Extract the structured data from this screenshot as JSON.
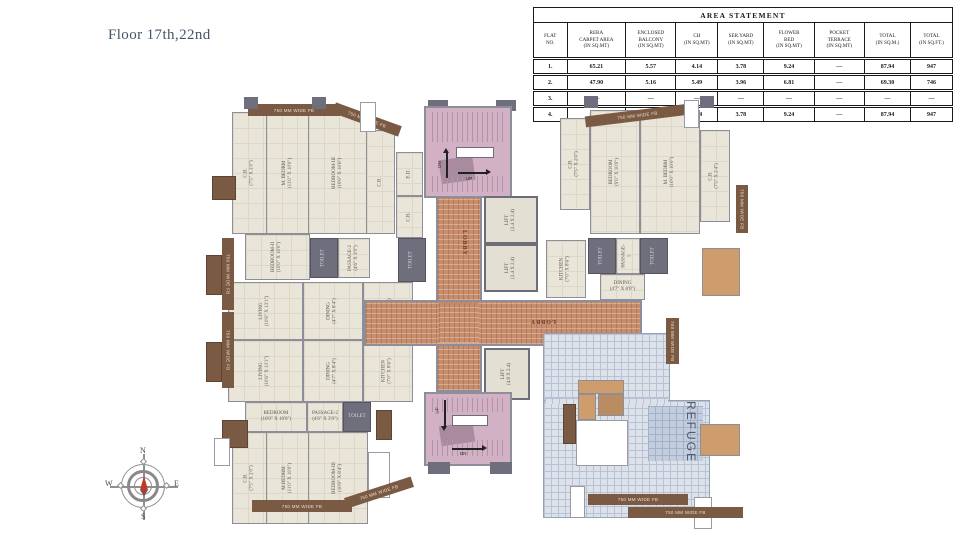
{
  "page": {
    "title": "Floor 17th,22nd"
  },
  "area_statement": {
    "title": "AREA STATEMENT",
    "columns": [
      "FLAT\nNO.",
      "RERA\nCARPET AREA\n(IN SQ.MT)",
      "ENCLOSED\nBALCONY\n(IN SQ.MT)",
      "CH\n(IN SQ.MT)",
      "SER.YARD\n(IN SQ.MT)",
      "FLOWER\nBED\n(IN SQ.MT)",
      "POCKET\nTERRACE\n(IN SQ.MT)",
      "TOTAL\n(IN SQ.M.)",
      "TOTAL\n(IN SQ.FT.)"
    ],
    "rows": [
      {
        "flat": "1.",
        "values": [
          "65.21",
          "5.57",
          "4.14",
          "3.78",
          "9.24",
          "—",
          "87.94",
          "947"
        ]
      },
      {
        "flat": "2.",
        "values": [
          "47.90",
          "5.16",
          "5.49",
          "3.96",
          "6.81",
          "—",
          "69.30",
          "746"
        ]
      },
      {
        "flat": "3.",
        "values": [
          "—",
          "—",
          "—",
          "—",
          "—",
          "—",
          "—",
          "—"
        ]
      },
      {
        "flat": "4.",
        "values": [
          "65.21",
          "5.57",
          "4.14",
          "3.78",
          "9.24",
          "—",
          "87.94",
          "947"
        ]
      }
    ]
  },
  "compass": {
    "n": "N",
    "e": "E",
    "s": "S",
    "w": "W"
  },
  "plan": {
    "lobby_label": "LOBBY",
    "refuge_label": "REFUGE",
    "stair_up": "UP",
    "stair_dn": "DN",
    "flower_bed_label": "750 MM WIDE FB",
    "rooms": {
      "tl_cb": "C.B.\n(7'5\" X 2'0\")",
      "tl_mbedrm": "M. BEDRM\n(11'0\" X 10'0\")",
      "tl_bed3": "BEDROOM-III\n(10'0\" X 10'6\")",
      "tl_cb2": "C.B.",
      "tl_passage": "PASSAGE-2\n(4'6\" X 3'9\")",
      "toilet": "TOILET",
      "lm_bed2": "BEDROOM-II\n(10'0\" X 10'0\")",
      "lm_living1": "LIVING\n(10'6\" X 13'1\")",
      "lm_living2": "LIVING\n(10'6\" X 13'1\")",
      "lm_dining1": "DINING\n(4'7\" X 8'4\")",
      "lm_dining2": "DINING\n(4'7\" X 8'4\")",
      "lm_kitchen1": "KITCHEN\n(7'0\" X 8'6\")",
      "lm_kitchen2": "KITCHEN\n(7'0\" X 8'6\")",
      "bl_bedroom": "BEDROOM\n(10'0\" X 10'0\")",
      "bl_passage": "PASSAGE-2\n(4'6\" X 3'9\")",
      "bl_cb": "C.B.\n(7'5\" X 2'0\")",
      "bl_mbedrm": "M.BEDRM\n(11'0\" X 10'0\")",
      "bl_bed3": "BEDROOM-III\n(10'0\" X 8'4\")",
      "rt_cb1": "C.B.\n(7'5\" X 2'0\")",
      "rt_bedroom": "BEDROOM\n(9'0\" X 10'0\")",
      "rt_mbedrm": "M. BEDRM\n(10'0\" X 10'0\")",
      "rt_cb2": "C.B.\n(7'5\" X 2'4\")",
      "rt_passage": "PASSAGE-1",
      "rt_kitchen": "KITCHEN\n(7'0\" X 8'6\")",
      "rt_dining": "DINING\n(4'7\" X 8'0\")",
      "ed": "E.D.",
      "cb_small": "C.B.",
      "lift_a": "LIFT\n(2.4 X 2.4)",
      "lift_b": "LIFT\n(2.4 X 2.4)",
      "lift_c": "LIFT\n(4.8 X 2.4)"
    }
  }
}
